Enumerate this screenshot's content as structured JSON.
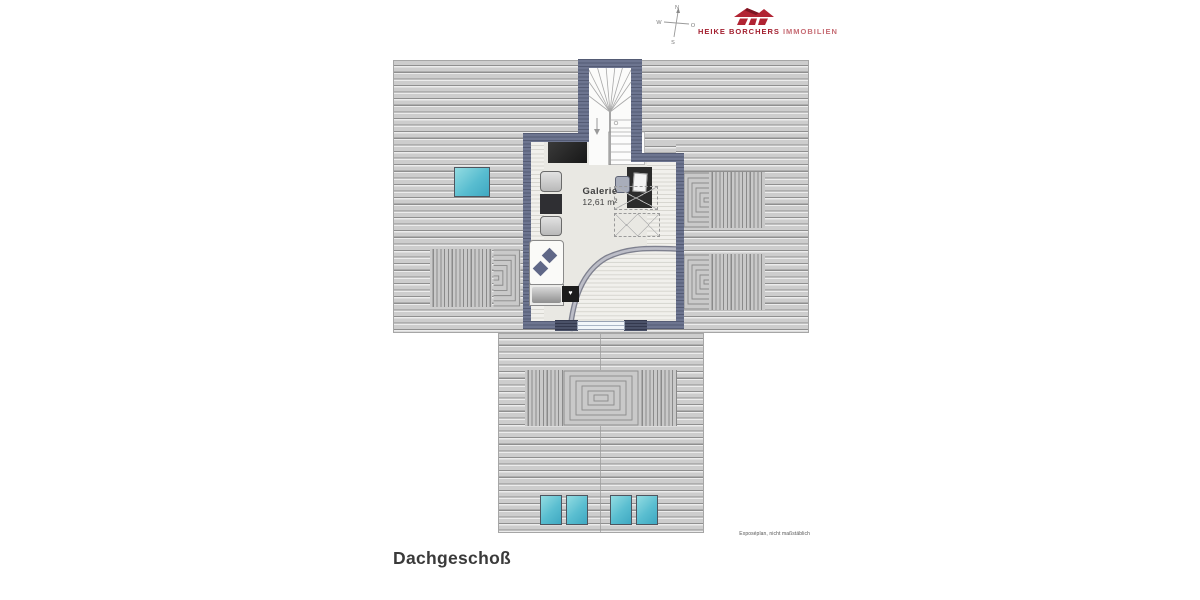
{
  "header": {
    "compass": {
      "n": "N",
      "w": "W",
      "o": "O",
      "s": "S"
    },
    "logo": {
      "brand": "HEIKE BORCHERS",
      "suffix": "IMMOBILIEN",
      "brand_color": "#a32030",
      "suffix_color": "#c76d75"
    }
  },
  "plan": {
    "room_label": "Galerie",
    "room_area": "12,61 m²",
    "heart_glyph": "♥",
    "colors": {
      "wall": "#6d7590",
      "wall_dark": "#4a5168",
      "roof_light": "#cdcdcd",
      "roof_stripe": "#8f8f8f",
      "floor": "#e9e8e3",
      "skylight_light": "#93dce2",
      "skylight_dark": "#3ea8c2",
      "railing": "#7e808e"
    }
  },
  "footer": {
    "title": "Dachgeschoß",
    "note": "Exposéplan, nicht maßstäblich"
  }
}
